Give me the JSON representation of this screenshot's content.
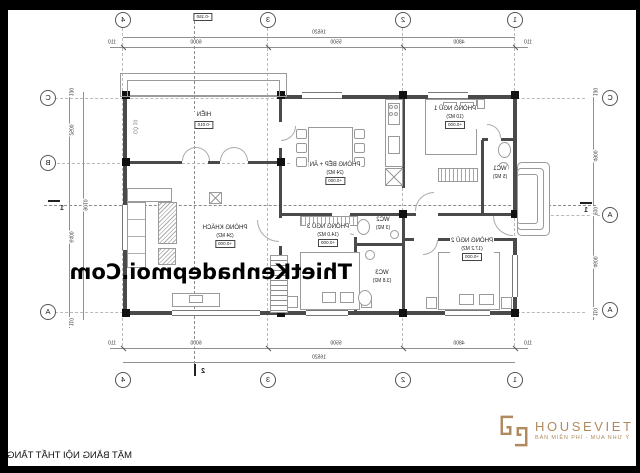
{
  "sheet": {
    "title": "MẶT BẰNG NỘI THẤT TẦNG 1"
  },
  "watermark": {
    "text": "ThietKenhadepmoi.Com"
  },
  "logo": {
    "brand": "HOUSEVIET",
    "tagline": "BẢN MIỄN PHÍ - MUA NHƯ Ý",
    "color": "#b08a5e"
  },
  "yard": {
    "label": "SÂN",
    "level": "-0.150"
  },
  "rooms": {
    "hien": {
      "name": "HIÊN",
      "level": "-0.010",
      "note": "CỎ 10"
    },
    "living": {
      "name": "PHÒNG KHÁCH",
      "area": "(34 M2)",
      "level": "+0.000"
    },
    "kitchen": {
      "name": "PHÒNG BẾP + ĂN",
      "area": "(24 M2)",
      "level": "+0.000"
    },
    "bed1": {
      "name": "PHÒNG NGỦ 1",
      "area": "(10 M2)",
      "level": "+0.000"
    },
    "bed2": {
      "name": "PHÒNG NGỦ 2",
      "area": "(17.2 M2)",
      "level": "+0.000"
    },
    "bed3": {
      "name": "PHÒNG NGỦ 3",
      "area": "(14.0 M2)",
      "level": "+0.000"
    },
    "wc1": {
      "name": "WC1",
      "area": "(5 M2)"
    },
    "wc2": {
      "name": "WC2",
      "area": "(3 M2)"
    },
    "wc3": {
      "name": "WC3",
      "area": "(3.8 M2)"
    }
  },
  "grid": {
    "cols": [
      "1",
      "2",
      "3",
      "4"
    ],
    "side_a": [
      "C",
      "A",
      "A"
    ],
    "side_b": [
      "C",
      "B",
      "A"
    ],
    "section_v": "2",
    "section_h": "1"
  },
  "dims": {
    "h_total": "16520",
    "h_segments": [
      "110",
      "4800",
      "5500",
      "6000",
      "110"
    ],
    "side_a_segments": [
      "130",
      "4900",
      "910",
      "4600",
      "110"
    ],
    "side_b_segments": [
      "130",
      "2500",
      "6400",
      "110"
    ],
    "side_b_total": "9010"
  }
}
